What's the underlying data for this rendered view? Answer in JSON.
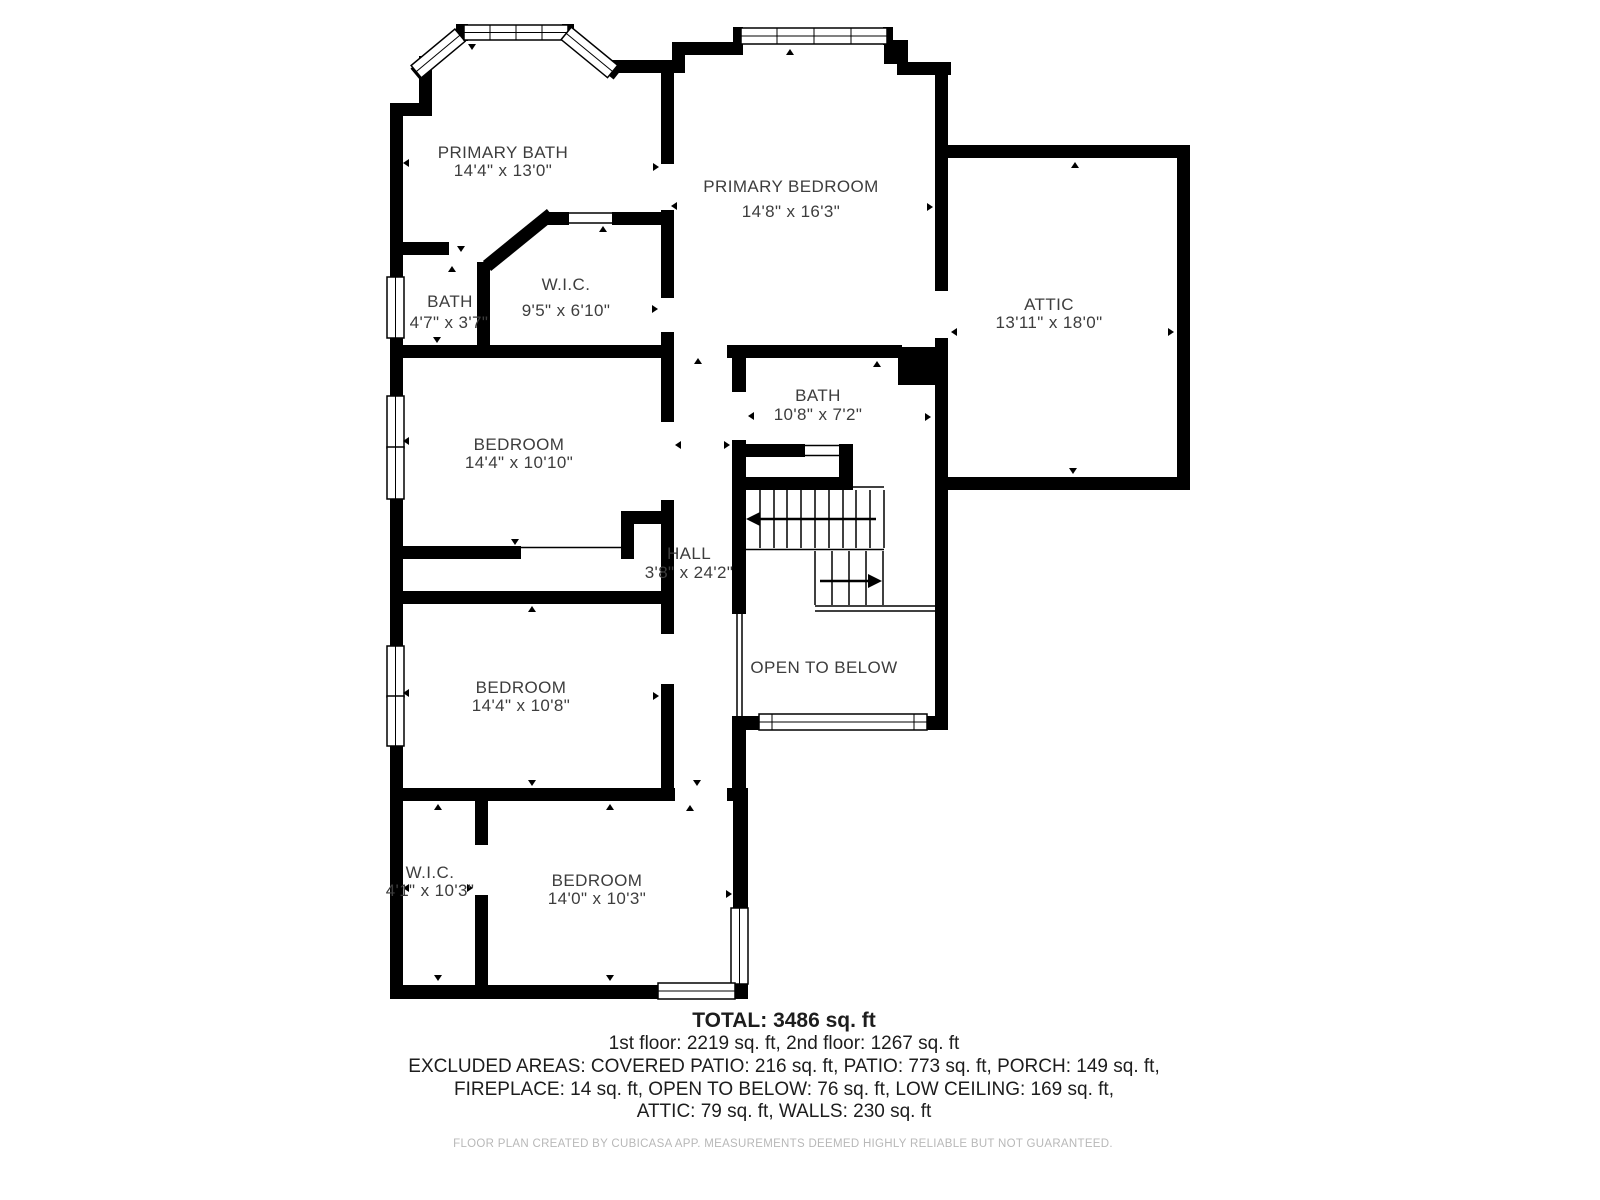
{
  "floorplan": {
    "title": "2nd floor plan",
    "rooms": [
      {
        "id": "primary-bath",
        "name": "PRIMARY BATH",
        "dims": "14'4\" x 13'0\""
      },
      {
        "id": "primary-bedroom",
        "name": "PRIMARY BEDROOM",
        "dims": "14'8\" x 16'3\""
      },
      {
        "id": "attic",
        "name": "ATTIC",
        "dims": "13'11\" x 18'0\""
      },
      {
        "id": "bath-small",
        "name": "BATH",
        "dims": "4'7\" x 3'7\""
      },
      {
        "id": "wic-primary",
        "name": "W.I.C.",
        "dims": "9'5\" x 6'10\""
      },
      {
        "id": "bath-mid",
        "name": "BATH",
        "dims": "10'8\" x 7'2\""
      },
      {
        "id": "bedroom-1",
        "name": "BEDROOM",
        "dims": "14'4\" x 10'10\""
      },
      {
        "id": "hall",
        "name": "HALL",
        "dims": "3'8\" x 24'2\""
      },
      {
        "id": "open-to-below",
        "name": "OPEN TO BELOW",
        "dims": ""
      },
      {
        "id": "bedroom-2",
        "name": "BEDROOM",
        "dims": "14'4\" x 10'8\""
      },
      {
        "id": "wic-2",
        "name": "W.I.C.",
        "dims": "4'1\" x 10'3\""
      },
      {
        "id": "bedroom-3",
        "name": "BEDROOM",
        "dims": "14'0\" x 10'3\""
      }
    ],
    "summary": {
      "total": "TOTAL: 3486 sq. ft",
      "floors": "1st floor: 2219 sq. ft, 2nd floor: 1267 sq. ft",
      "excluded1": "EXCLUDED AREAS: COVERED PATIO: 216 sq. ft, PATIO: 773 sq. ft, PORCH: 149 sq. ft,",
      "excluded2": "FIREPLACE: 14 sq. ft, OPEN TO BELOW: 76 sq. ft, LOW CEILING: 169 sq. ft,",
      "excluded3": "ATTIC: 79 sq. ft, WALLS: 230 sq. ft"
    },
    "disclaimer": "FLOOR PLAN CREATED BY CUBICASA APP. MEASUREMENTS DEEMED HIGHLY RELIABLE BUT NOT GUARANTEED.",
    "colors": {
      "wall": "#000000",
      "label": "#3d3d3d",
      "summary": "#1d1d1d",
      "disclaimer": "#b8b8b8"
    }
  }
}
